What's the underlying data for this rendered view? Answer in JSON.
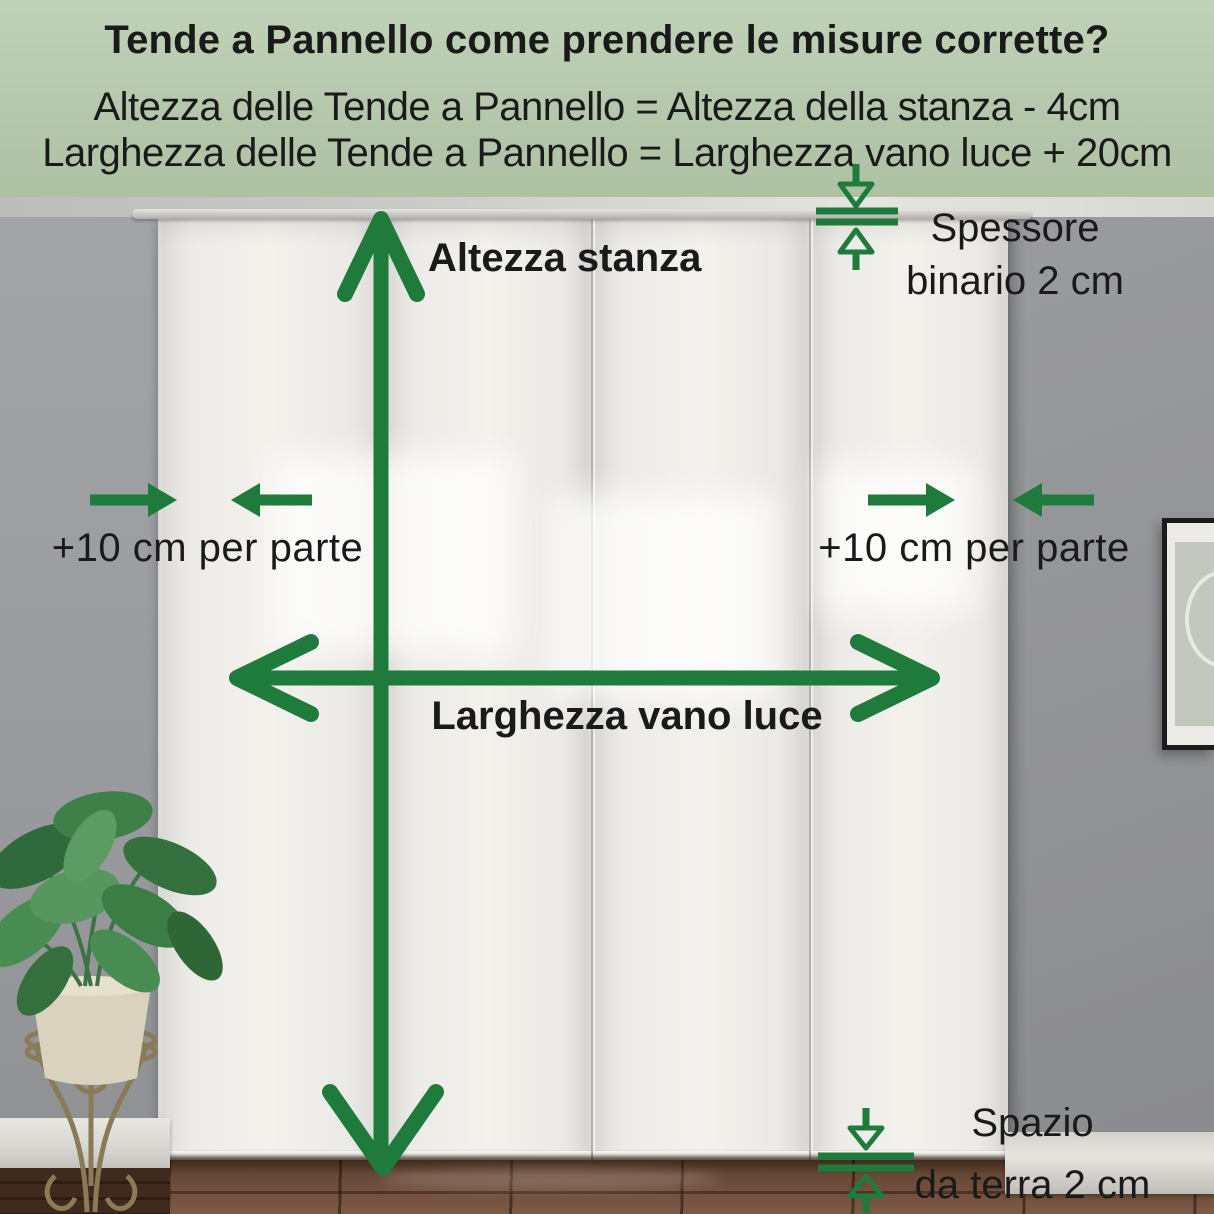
{
  "header": {
    "title": "Tende a Pannello come prendere le misure corrette?",
    "formulas": [
      "Altezza delle Tende a Pannello = Altezza della stanza - 4cm",
      "Larghezza delle Tende a Pannello = Larghezza vano luce + 20cm"
    ]
  },
  "labels": {
    "room_height": "Altezza stanza",
    "opening_width": "Larghezza vano luce",
    "extra_left": "+10 cm per parte",
    "extra_right": "+10 cm per parte",
    "rail_thickness_line1": "Spessore",
    "rail_thickness_line2": "binario 2 cm",
    "floor_gap_line1": "Spazio",
    "floor_gap_line2": "da terra 2 cm"
  },
  "icons": {
    "height_arrow": "vertical-double-arrow",
    "width_arrow": "horizontal-double-arrow",
    "extra_left_arrows": "inward-pointing-arrows",
    "extra_right_arrows": "inward-pointing-arrows",
    "rail_thickness_marker": "thickness-gauge-arrows",
    "floor_gap_marker": "gap-gauge-arrows"
  },
  "colors": {
    "accent_green": "#1e7b3c",
    "header_bg": "#b4c6ab",
    "text": "#1a1a1a"
  }
}
